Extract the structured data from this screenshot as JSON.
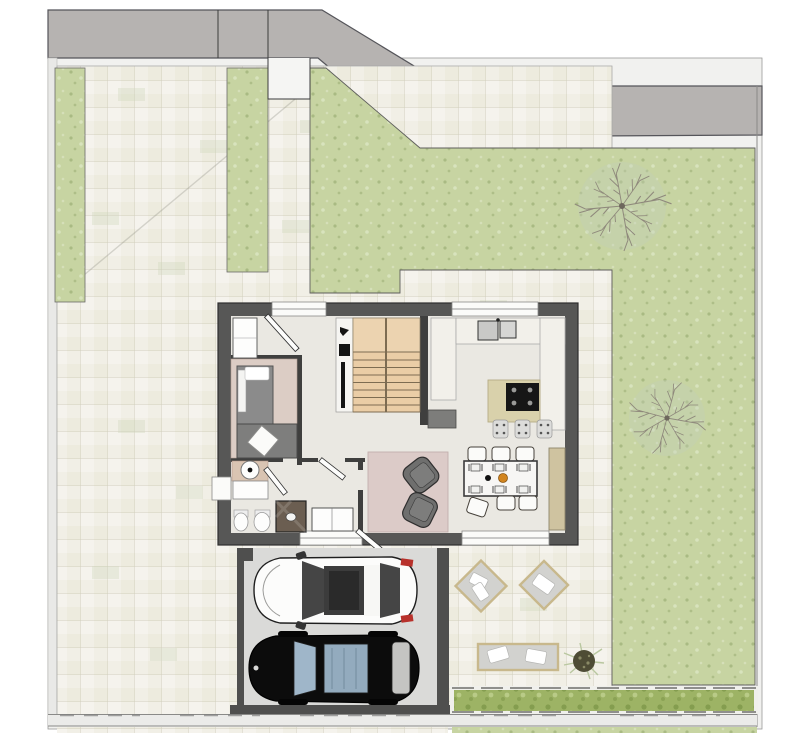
{
  "scene": {
    "kind": "architectural-site-plan",
    "view": "top-down-floor-plan",
    "canvas": {
      "width": 800,
      "height": 733
    }
  },
  "colors": {
    "road": "#b6b3b1",
    "sidewalk": "#f1f1ef",
    "paving": "#f1efe6",
    "lawn": "#c7d4a2",
    "hedge": "#9db365",
    "houseWall": "#575756",
    "interiorFloor": "#eae8e2",
    "studyFloor": "#dccdc5",
    "rug": "#dccbc8",
    "stairWood": "#eacda6",
    "islandTop": "#d9d1ab",
    "sideboard": "#cfc3a0",
    "counter": "#f2f0ea",
    "cooktop": "#161616",
    "driveway": "#dadad8",
    "garageWall": "#4f4f4e",
    "carWhiteBody": "#fcfcfb",
    "carBlackBody": "#0c0c0c",
    "carGlassBlue": "#9fb6c9",
    "taillightRed": "#b8312b",
    "matGray": "#d2d2cf",
    "matTrim": "#c8b88c",
    "pillowWhite": "#ffffff",
    "shrubDark": "#4e4c35",
    "treeBranch": "#8f897c",
    "armchairGray": "#6f6f6e",
    "fixtureWhite": "#fdfdfc",
    "showerBrown": "#6b5e51",
    "basinCounter": "#d9c4b2",
    "tableWhite": "#f7f6f4",
    "bowlOrange": "#d2851f"
  },
  "features": [
    {
      "name": "street-band",
      "kind": "road"
    },
    {
      "name": "entry-walk",
      "kind": "path"
    },
    {
      "name": "paved-patio",
      "kind": "paving"
    },
    {
      "name": "lawn",
      "kind": "grass"
    },
    {
      "name": "planting-strip-left",
      "kind": "grass"
    },
    {
      "name": "planting-strip-middle",
      "kind": "grass"
    },
    {
      "name": "deciduous-tree-north",
      "kind": "tree"
    },
    {
      "name": "deciduous-tree-east",
      "kind": "tree"
    },
    {
      "name": "house",
      "kind": "building"
    },
    {
      "name": "study-room",
      "kind": "room"
    },
    {
      "name": "bathroom",
      "kind": "room"
    },
    {
      "name": "staircase",
      "kind": "stairs"
    },
    {
      "name": "kitchen",
      "kind": "room"
    },
    {
      "name": "dining-table",
      "kind": "furniture"
    },
    {
      "name": "living-rug-with-armchairs",
      "kind": "furniture"
    },
    {
      "name": "driveway",
      "kind": "carport"
    },
    {
      "name": "white-car",
      "kind": "vehicle"
    },
    {
      "name": "black-car",
      "kind": "vehicle"
    },
    {
      "name": "terrace-lounge-mats",
      "kind": "furniture"
    },
    {
      "name": "shrub",
      "kind": "plant"
    },
    {
      "name": "hedge-south",
      "kind": "hedge"
    }
  ]
}
